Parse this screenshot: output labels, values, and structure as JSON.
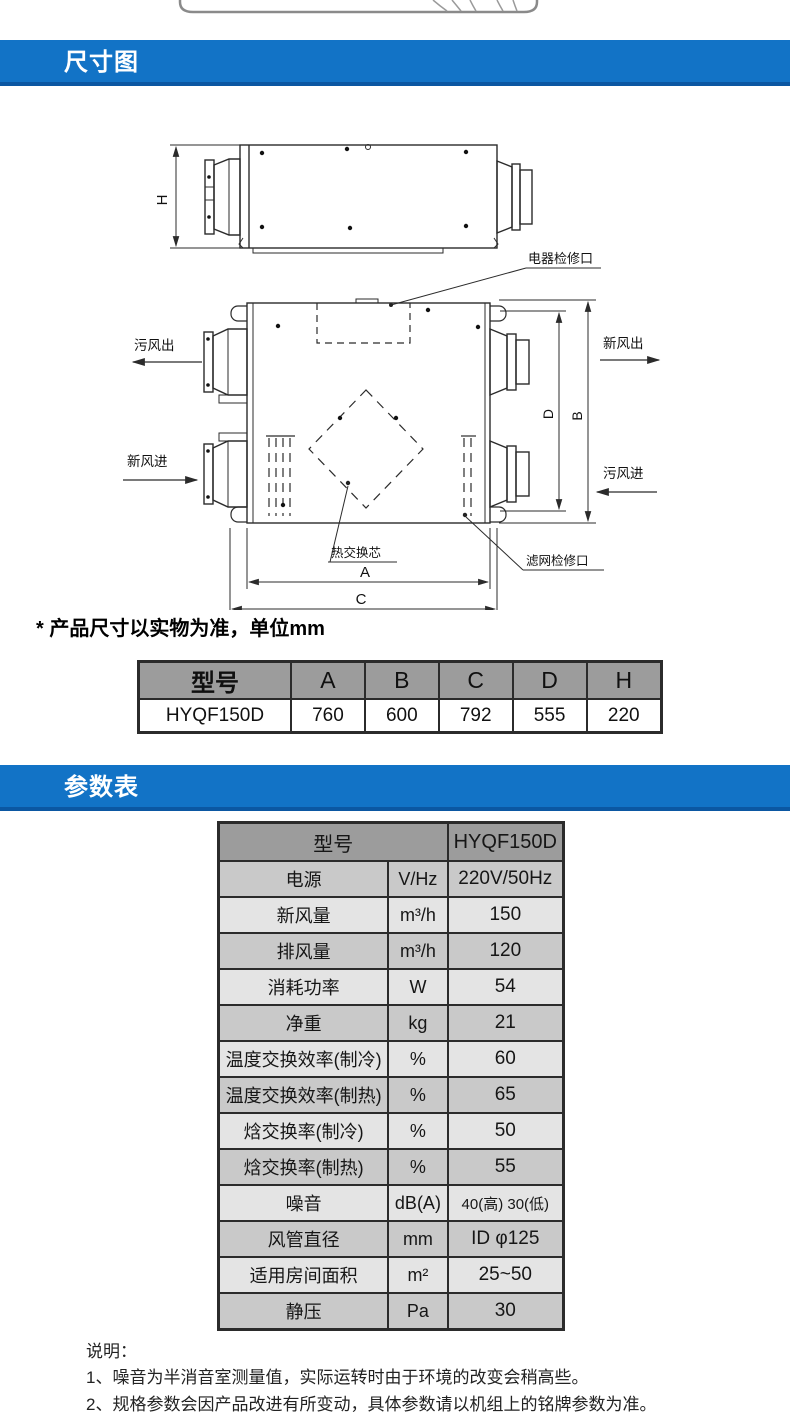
{
  "colors": {
    "header_bar": "#1273c6",
    "header_bar_edge": "#0b57a2",
    "table_head_bg": "#9c9c9c",
    "row_gray": "#c9c9c9",
    "row_light": "#e4e4e4",
    "line": "#2b2b2b"
  },
  "section_headers": {
    "dimensions": "尺寸图",
    "parameters": "参数表"
  },
  "diagram": {
    "dim_letters": {
      "H": "H",
      "A": "A",
      "B": "B",
      "C": "C",
      "D": "D"
    },
    "callouts": {
      "electric_access": "电器检修口",
      "filter_access": "滤网检修口",
      "heat_core": "热交换芯"
    },
    "flows": {
      "dirty_out": "污风出",
      "fresh_in": "新风进",
      "fresh_out": "新风出",
      "dirty_in": "污风进"
    },
    "note": "* 产品尺寸以实物为准，单位mm"
  },
  "dimension_table": {
    "headers": [
      "型号",
      "A",
      "B",
      "C",
      "D",
      "H"
    ],
    "row": [
      "HYQF150D",
      "760",
      "600",
      "792",
      "555",
      "220"
    ]
  },
  "parameter_table": {
    "model_label": "型号",
    "model_value": "HYQF150D",
    "rows": [
      {
        "label": "电源",
        "unit": "V/Hz",
        "value": "220V/50Hz"
      },
      {
        "label": "新风量",
        "unit": "m³/h",
        "value": "150"
      },
      {
        "label": "排风量",
        "unit": "m³/h",
        "value": "120"
      },
      {
        "label": "消耗功率",
        "unit": "W",
        "value": "54"
      },
      {
        "label": "净重",
        "unit": "kg",
        "value": "21"
      },
      {
        "label": "温度交换效率(制冷)",
        "unit": "%",
        "value": "60"
      },
      {
        "label": "温度交换效率(制热)",
        "unit": "%",
        "value": "65"
      },
      {
        "label": "焓交换率(制冷)",
        "unit": "%",
        "value": "50"
      },
      {
        "label": "焓交换率(制热)",
        "unit": "%",
        "value": "55"
      },
      {
        "label": "噪音",
        "unit": "dB(A)",
        "value": "40(高) 30(低)"
      },
      {
        "label": "风管直径",
        "unit": "mm",
        "value": "ID φ125"
      },
      {
        "label": "适用房间面积",
        "unit": "m²",
        "value": "25~50"
      },
      {
        "label": "静压",
        "unit": "Pa",
        "value": "30"
      }
    ]
  },
  "notes": {
    "title": "说明：",
    "items": [
      "1、噪音为半消音室测量值，实际运转时由于环境的改变会稍高些。",
      "2、规格参数会因产品改进有所变动，具体参数请以机组上的铭牌参数为准。"
    ]
  }
}
